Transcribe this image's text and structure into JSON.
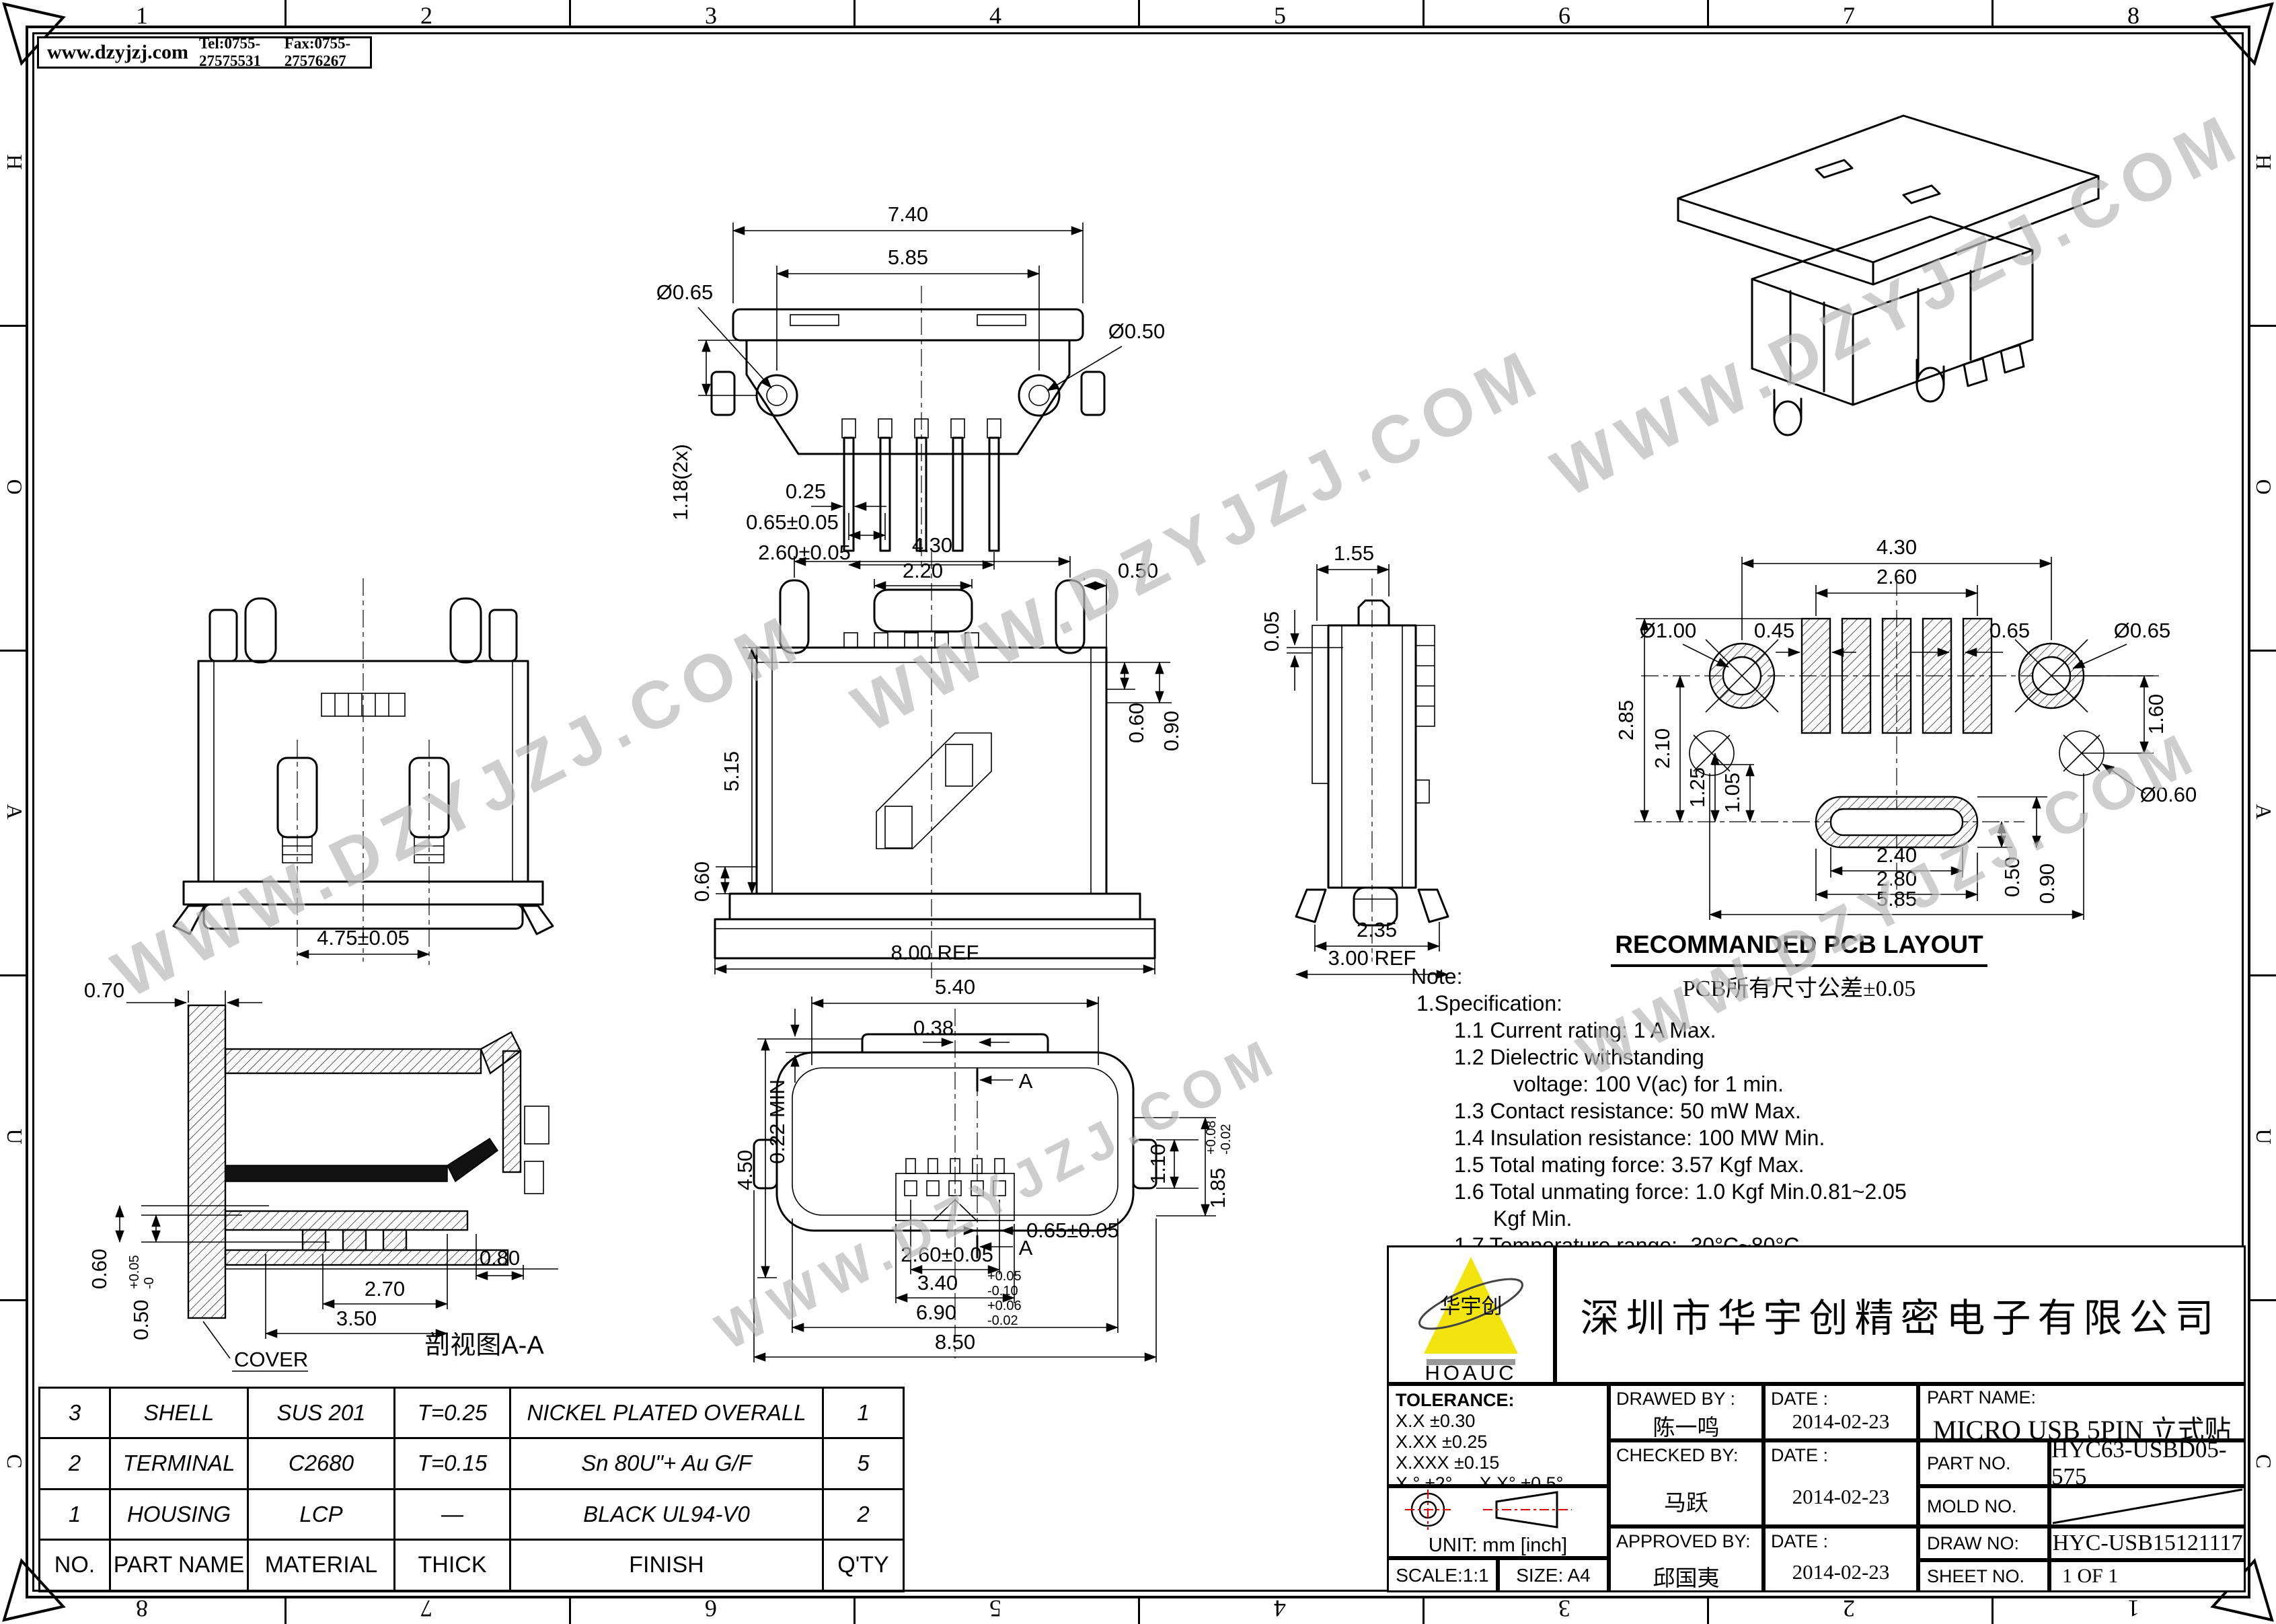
{
  "frame": {
    "zones_h": [
      "1",
      "2",
      "3",
      "4",
      "5",
      "6",
      "7",
      "8"
    ],
    "zones_v": [
      "H",
      "O",
      "A",
      "U",
      "C"
    ]
  },
  "header": {
    "site": "www.dzyjzj.com",
    "tel": "Tel:0755-27575531",
    "fax": "Fax:0755-27576267"
  },
  "watermark": {
    "text": "WWW.DZYJZJ.COM"
  },
  "views": {
    "top": {
      "d_w": "7.40",
      "d_w2": "5.85",
      "d_hole_l": "Ø0.65",
      "d_hole_r": "Ø0.50",
      "d_h": "1.18(2x)",
      "d_pin": "0.25",
      "d_pitch": "0.65±0.05",
      "d_span": "2.60±0.05"
    },
    "front": {
      "d_lug": "4.75±0.05"
    },
    "center": {
      "d1": "4.30",
      "d2": "2.20",
      "d3": "0.50",
      "d4": "0.60",
      "d5": "0.90",
      "d6": "5.15",
      "d7": "0.60",
      "d8": "8.00 REF"
    },
    "side": {
      "d1": "1.55",
      "d2": "0.05",
      "d3": "2.35",
      "d4": "3.00 REF"
    },
    "pcb": {
      "title": "RECOMMANDED PCB LAYOUT",
      "subtitle": "PCB所有尺寸公差±0.05",
      "d1": "4.30",
      "d2": "2.60",
      "d3": "Ø1.00",
      "d4": "0.45",
      "d5": "0.65",
      "d6": "Ø0.65",
      "d7": "1.60",
      "d8": "Ø0.60",
      "d9": "2.85",
      "d10": "2.10",
      "d11": "1.25",
      "d12": "1.05",
      "d13": "2.40",
      "d14": "0.50",
      "d15": "0.90",
      "d16": "2.80",
      "d17": "5.85"
    },
    "bottom": {
      "d1": "5.40",
      "d2": "0.38",
      "sec": "A",
      "d3": "4.50",
      "d4": "0.22 MIN",
      "d5": "1.10",
      "d6": "1.85",
      "d6u": "+0.08",
      "d6d": "-0.02",
      "d7": "0.65±0.05",
      "d8": "2.60±0.05",
      "d9": "3.40",
      "d9u": "+0.05",
      "d9d": "-0.10",
      "d10": "6.90",
      "d10u": "+0.06",
      "d10d": "-0.02",
      "d11": "8.50"
    },
    "section": {
      "label": "剖视图A-A",
      "cover": "COVER",
      "d1": "0.70",
      "d2": "0.60",
      "d3": "0.50",
      "d3u": "+0.05",
      "d3d": "-0",
      "d4": "2.70",
      "d5": "3.50",
      "d6": "0.80"
    }
  },
  "notes": {
    "l0": "Note:",
    "l1": "1.Specification:",
    "l2": "1.1 Current rating: 1 A Max.",
    "l3": "1.2 Dielectric withstanding",
    "l4": "voltage: 100 V(ac) for 1 min.",
    "l5": "1.3 Contact resistance: 50 mW Max.",
    "l6": "1.4 Insulation resistance: 100 MW Min.",
    "l7": "1.5 Total mating force: 3.57 Kgf Max.",
    "l8": "1.6 Total unmating force: 1.0 Kgf Min.0.81~2.05",
    "l9": "Kgf Min.",
    "l10": "1.7 Temperature range: -30°C~80°C"
  },
  "parts_table": {
    "headers": [
      "NO.",
      "PART NAME",
      "MATERIAL",
      "THICK",
      "FINISH",
      "Q'TY"
    ],
    "rows": [
      [
        "3",
        "SHELL",
        "SUS 201",
        "T=0.25",
        "NICKEL PLATED OVERALL",
        "1"
      ],
      [
        "2",
        "TERMINAL",
        "C2680",
        "T=0.15",
        "Sn 80U\"+ Au G/F",
        "5"
      ],
      [
        "1",
        "HOUSING",
        "LCP",
        "—",
        "BLACK UL94-V0",
        "2"
      ]
    ]
  },
  "title_block": {
    "company": "深圳市华宇创精密电子有限公司",
    "logo_cn": "华宇创",
    "logo_en": "HOAUC",
    "tolerance_label": "TOLERANCE:",
    "tol1": "X.X    ±0.30",
    "tol2": "X.XX   ±0.25",
    "tol3": "X.XXX  ±0.15",
    "tol_ang": "X.°  ±2°",
    "tol_ang2": "X.X°  ±0.5°",
    "unit": "UNIT:  mm  [inch]",
    "scale": "SCALE:1:1",
    "size": "SIZE:  A4",
    "drawed_label": "DRAWED BY :",
    "checked_label": "CHECKED BY:",
    "approved_label": "APPROVED BY:",
    "date_label": "DATE :",
    "drawed_by": "陈一鸣",
    "checked_by": "马跃",
    "approved_by": "邱国夷",
    "date_drawed": "2014-02-23",
    "date_checked": "2014-02-23",
    "date_approved": "2014-02-23",
    "part_name_label": "PART NAME:",
    "part_name": "MICRO USB 5PIN 立式贴片",
    "part_no_label": "PART NO.",
    "part_no": "HYC63-USBD05-575",
    "mold_no_label": "MOLD NO.",
    "draw_no_label": "DRAW NO:",
    "draw_no": "HYC-USB15121117",
    "sheet_no_label": "SHEET NO.",
    "sheet_no": "1 OF 1"
  },
  "colors": {
    "logo_yellow": "#f2e50f",
    "accent_red": "#e60000",
    "watermark_gray": "#7d7d7d"
  }
}
